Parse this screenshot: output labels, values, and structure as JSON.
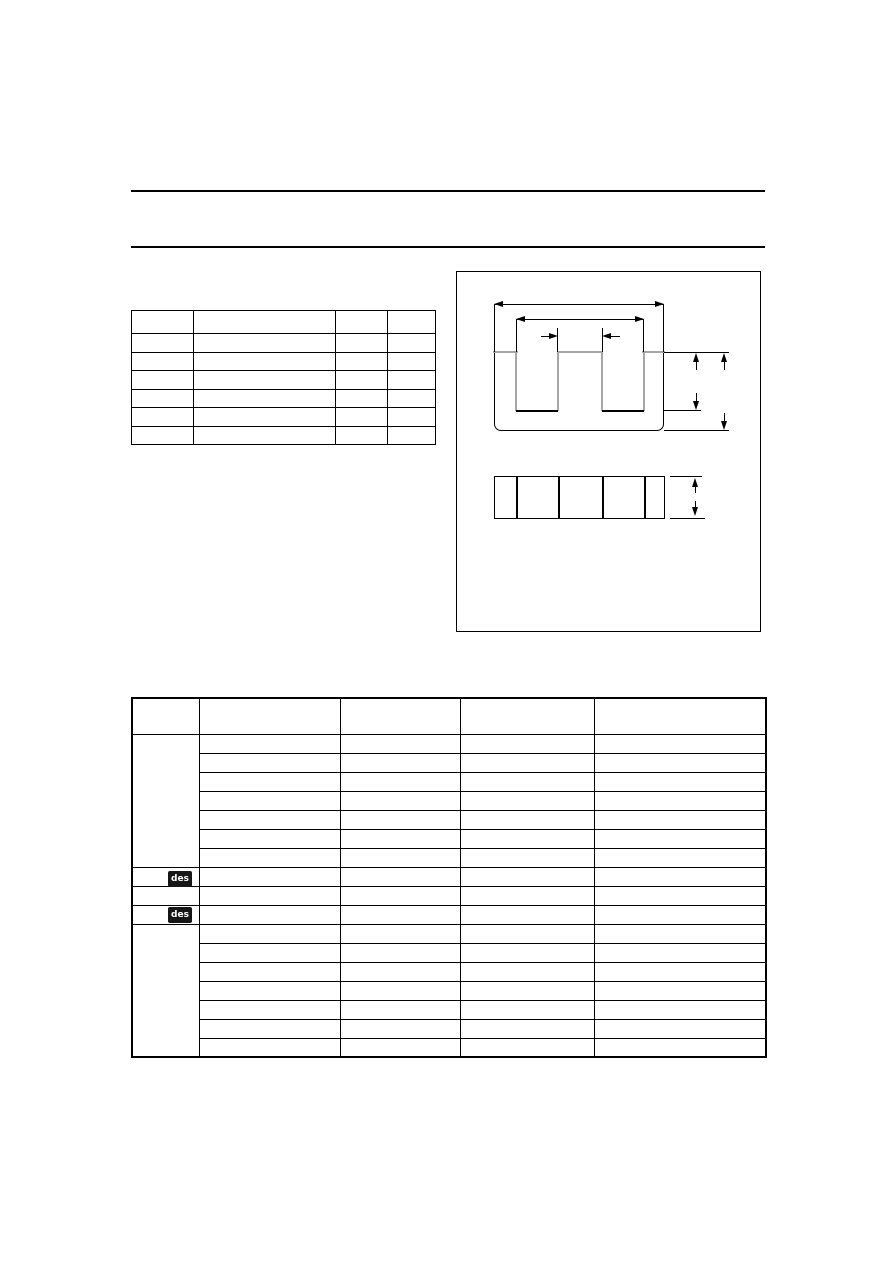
{
  "page": {
    "width_px": 893,
    "height_px": 1263,
    "background": "#ffffff"
  },
  "colors": {
    "line": "#000000",
    "outline-gray": "#a6a6a6",
    "badge-bg": "#161616",
    "badge-text": "#ffffff"
  },
  "header": {
    "rule_count": 2
  },
  "parameter_table": {
    "column_count": 4,
    "row_count": 7,
    "all_cells_empty": true
  },
  "figure": {
    "views": [
      "package-front-view",
      "package-side-view"
    ],
    "side_view_segment_count": 5
  },
  "dimension_table": {
    "column_count": 5,
    "group1_row_count": 7,
    "middle_rows": [
      {
        "col1_badge": "des"
      },
      {
        "col1_badge": ""
      },
      {
        "col1_badge": "des"
      }
    ],
    "group2_row_count": 7
  }
}
